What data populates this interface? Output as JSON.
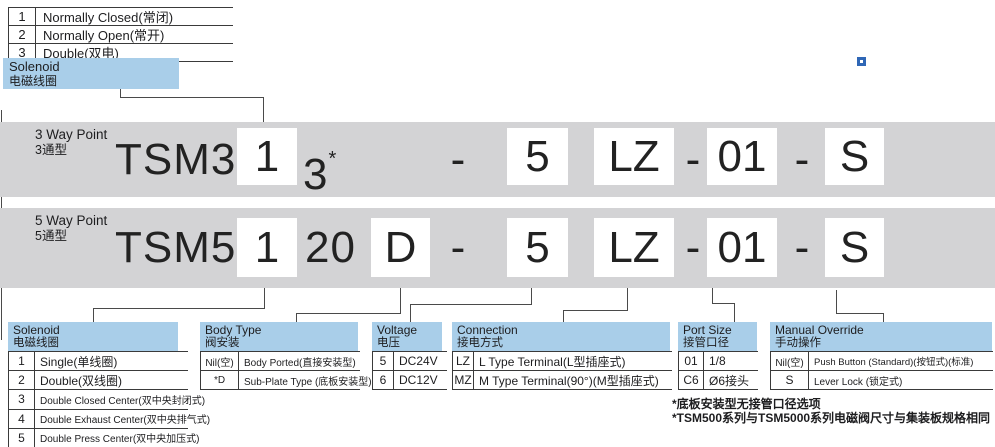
{
  "colors": {
    "band_gray": "#d3d3d5",
    "header_blue": "#a9cee9",
    "marker_blue": "#2f67b6",
    "line_dark": "#4a4a4a"
  },
  "symbols": {
    "dash": "-",
    "asterisk": "*"
  },
  "top_table": {
    "rows": [
      [
        "1",
        "Normally Closed(常闭)"
      ],
      [
        "2",
        "Normally Open(常开)"
      ],
      [
        "3",
        "Double(双电)"
      ]
    ]
  },
  "solenoid_callout": {
    "en": "Solenoid",
    "zh": "电磁线圈"
  },
  "bands": [
    {
      "title_en": "3 Way Point",
      "title_zh": "3通型",
      "prefix": "TSM3",
      "solenoid": "1",
      "port": "3",
      "voltage": "5",
      "connection": "LZ",
      "port_size": "01",
      "override": "S"
    },
    {
      "title_en": "5 Way Point",
      "title_zh": "5通型",
      "prefix": "TSM5",
      "solenoid": "1",
      "series": "20",
      "body": "D",
      "voltage": "5",
      "connection": "LZ",
      "port_size": "01",
      "override": "S"
    }
  ],
  "tables": {
    "solenoid": {
      "title_en": "Solenoid",
      "title_zh": "电磁线圈",
      "rows": [
        [
          "1",
          "Single(单线圈)"
        ],
        [
          "2",
          "Double(双线圈)"
        ],
        [
          "3",
          "Double Closed Center(双中央封闭式)"
        ],
        [
          "4",
          "Double Exhaust Center(双中央排气式)"
        ],
        [
          "5",
          "Double Press Center(双中央加压式)"
        ]
      ]
    },
    "body_type": {
      "title_en": "Body Type",
      "title_zh": "阀安装",
      "rows": [
        [
          "Nil(空)",
          "Body Ported(直接安装型)"
        ],
        [
          "*D",
          "Sub-Plate Type (底板安装型)"
        ]
      ]
    },
    "voltage": {
      "title_en": "Voltage",
      "title_zh": "电压",
      "rows": [
        [
          "5",
          "DC24V"
        ],
        [
          "6",
          "DC12V"
        ]
      ]
    },
    "connection": {
      "title_en": "Connection",
      "title_zh": "接电方式",
      "rows": [
        [
          "LZ",
          "L Type Terminal(L型插座式)"
        ],
        [
          "MZ",
          "M Type Terminal(90°)(M型插座式)"
        ]
      ]
    },
    "port_size": {
      "title_en": "Port Size",
      "title_zh": "接管口径",
      "rows": [
        [
          "01",
          "1/8"
        ],
        [
          "C6",
          "Ø6接头"
        ]
      ]
    },
    "manual_override": {
      "title_en": "Manual Override",
      "title_zh": "手动操作",
      "rows": [
        [
          "Nil(空)",
          "Push Button (Standard)(按钮式)(标准)"
        ],
        [
          "S",
          "Lever Lock (锁定式)"
        ]
      ]
    }
  },
  "notes": [
    "*底板安装型无接管口径选项",
    "*TSM500系列与TSM5000系列电磁阀尺寸与集装板规格相同"
  ]
}
